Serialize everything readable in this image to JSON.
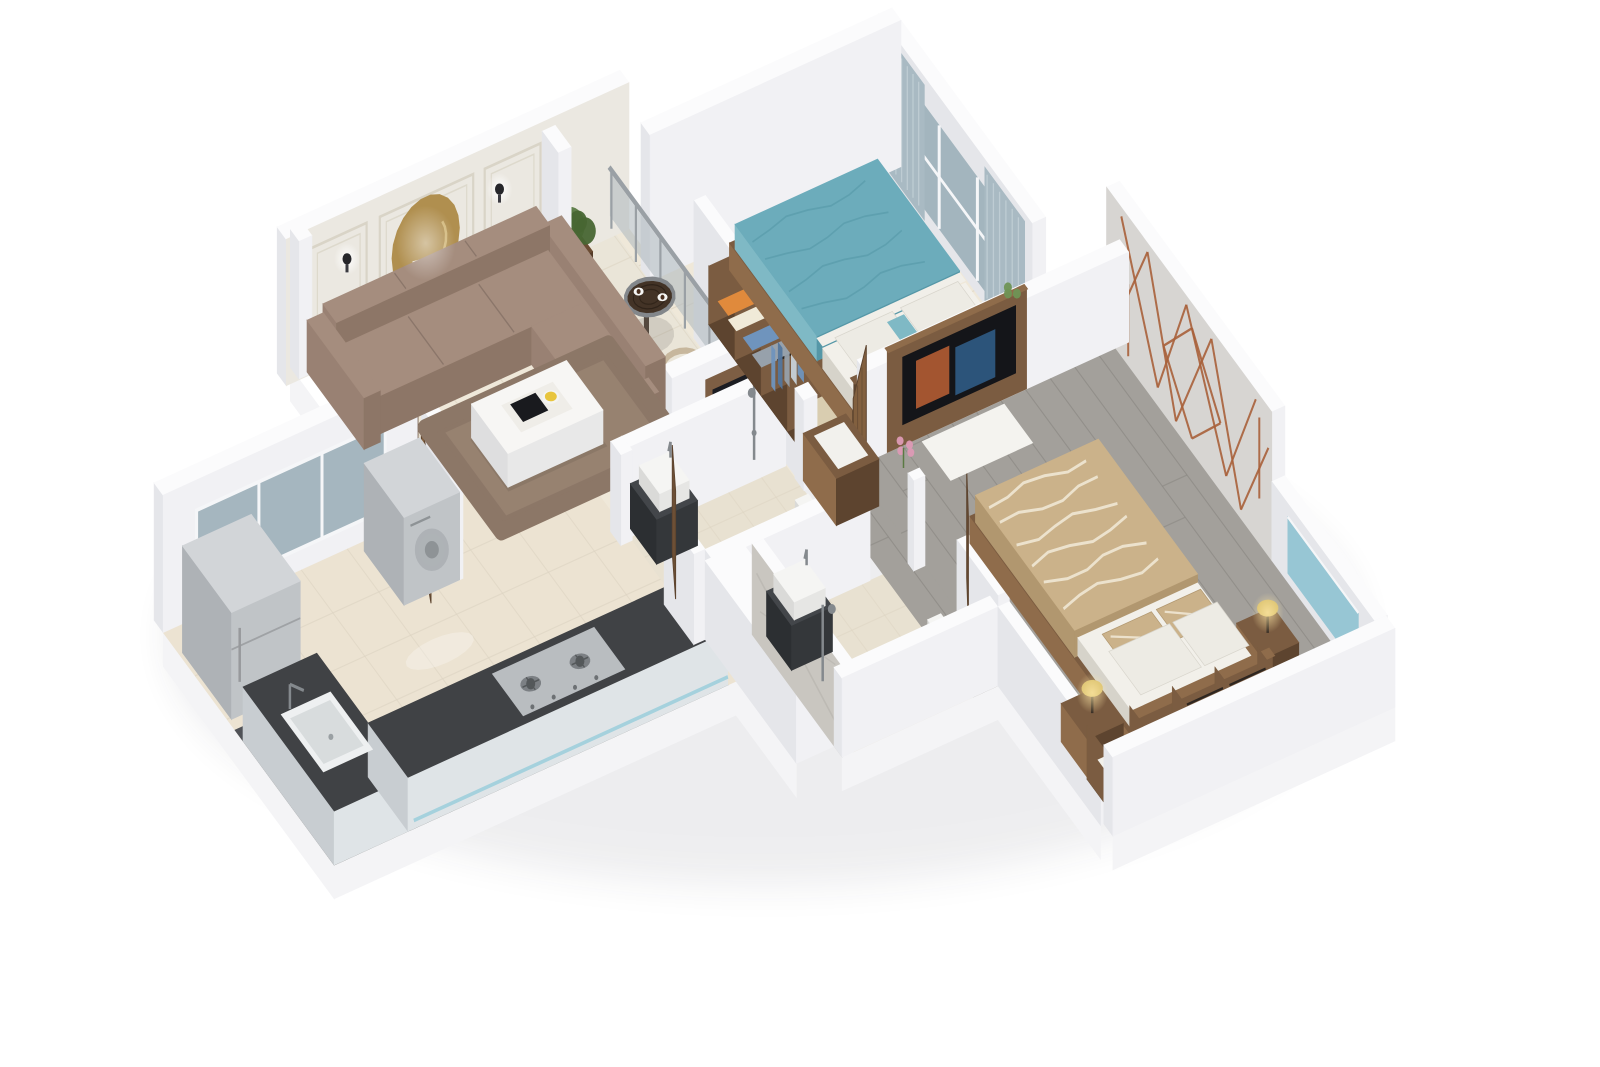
{
  "scene": {
    "kind": "isometric-3d-floor-plan-render",
    "background": "#ffffff",
    "view": "cutaway-birdseye"
  },
  "rooms": [
    {
      "id": "living-room",
      "label": "living room"
    },
    {
      "id": "balcony",
      "label": "balcony"
    },
    {
      "id": "bedroom-1",
      "label": "bedroom 1"
    },
    {
      "id": "bedroom-2",
      "label": "bedroom 2"
    },
    {
      "id": "kitchen",
      "label": "kitchen"
    },
    {
      "id": "bathroom-1",
      "label": "bathroom 1"
    },
    {
      "id": "bathroom-2",
      "label": "bathroom 2"
    },
    {
      "id": "hallway",
      "label": "hallway"
    }
  ],
  "furniture": [
    {
      "room": "living-room",
      "items": [
        "l-shaped-sofa",
        "coffee-table",
        "rug",
        "tv-panel",
        "accent-wall-art",
        "wall-sconces",
        "entry-door"
      ]
    },
    {
      "room": "balcony",
      "items": [
        "glass-railing",
        "round-table",
        "papasan-chair",
        "potted-plant",
        "glass-partition"
      ]
    },
    {
      "room": "bedroom-1",
      "items": [
        "double-bed-teal",
        "window-curtains",
        "open-wardrobe",
        "nightstand-candle"
      ]
    },
    {
      "room": "bedroom-2",
      "items": [
        "double-bed-tan",
        "marble-accent-wall-copper-lines",
        "tv-unit",
        "two-table-lamps",
        "open-wardrobe",
        "gray-plank-floor"
      ]
    },
    {
      "room": "kitchen",
      "items": [
        "l-counter-dark-top",
        "sink",
        "gas-hob",
        "refrigerator",
        "washing-machine",
        "sliding-window"
      ]
    },
    {
      "room": "bathroom-1",
      "items": [
        "basin",
        "toilet",
        "shower",
        "wooden-door"
      ]
    },
    {
      "room": "bathroom-2",
      "items": [
        "basin",
        "toilet",
        "shower",
        "wooden-door"
      ]
    }
  ],
  "colors": {
    "bg": "#ffffff",
    "shadow": "#2a2a3c",
    "wall_top": "#fbfbfc",
    "wall_s": "#f1f1f4",
    "wall_w": "#e5e6ea",
    "plinth": "#f4f4f6",
    "accent_wall": "#ebe8e1",
    "panel_line": "#d9d4c7",
    "art_gold": "#b08f4f",
    "art_gold_light": "#d6bc80",
    "sconce": "#26262a",
    "floor_cream": "#efe8d9",
    "floor_kitchen": "#ece3d2",
    "floor_bath": "#e8e1d1",
    "floor_balcony": "#eae5d8",
    "tile_line": "#ddd4c2",
    "floor_wood": "#a3a09b",
    "plank_line": "#87847f",
    "floor_dark": "#505257",
    "counter_top": "#404245",
    "counter_face": "#dfe4e7",
    "counter_side": "#c8cdd1",
    "teal_strip": "#9fd0dd",
    "sofa": "#a58d7e",
    "sofa_dark": "#8d7667",
    "sofa_mid": "#998173",
    "seam": "#8b766a",
    "rug": "#8c7767",
    "rug_light": "#a08b79",
    "wood": "#7b5c41",
    "wood_dark": "#5d442f",
    "wood_mid": "#8f6c4b",
    "door_wood": "#82603f",
    "linen": "#f2f0ea",
    "linen_face": "#e2dfd7",
    "linen_side": "#d6d3ca",
    "pillow": "#edebe4",
    "teal": "#6cacbb",
    "teal_dark": "#5597a7",
    "teal_mid": "#7fb9c5",
    "tan": "#cbb28a",
    "tan_dark": "#b1976f",
    "stripe_light": "#f0e7d4",
    "glass2": "#9fb2bb",
    "frame_white": "#f5f6f8",
    "curtain": "#a9bac3",
    "curtain_light": "#c4d1d8",
    "rail_glass": "#b3bcc1",
    "rail_metal": "#9aa0a5",
    "part_glass": "#c3cdd2",
    "marble": "#d7d5d2",
    "stone": "#c9c6c0",
    "copper": "#a9613b",
    "appl_top": "#d2d5d8",
    "appl_face": "#c0c4c7",
    "appl_side": "#aeb2b6",
    "steel": "#84898d",
    "white_fix": "#f5f5f3",
    "white_fix_face": "#e6e6e4",
    "white_fix_side": "#dadad8",
    "lamp": "#d8be69",
    "glow_y": "#ffe9a8",
    "plant1": "#5a7a43",
    "plant2": "#6f9455",
    "plant3": "#486633",
    "pot": "#6b4c33",
    "pot_dark": "#543b27",
    "chair_tan": "#c3b197",
    "chair_cushion": "#efeae0",
    "table_top": "#433326",
    "table_rim": "#83878b",
    "tv": "#16171b",
    "screen_warm": "#b05b33",
    "screen_cool": "#2f5a83",
    "flower": "#dd9ab5",
    "teal_glass": "#8fc3d2",
    "clothes": [
      "#6f94bd",
      "#54779e",
      "#97a1ab",
      "#c7d1d9",
      "#e08a3c",
      "#d9cdb0"
    ]
  }
}
